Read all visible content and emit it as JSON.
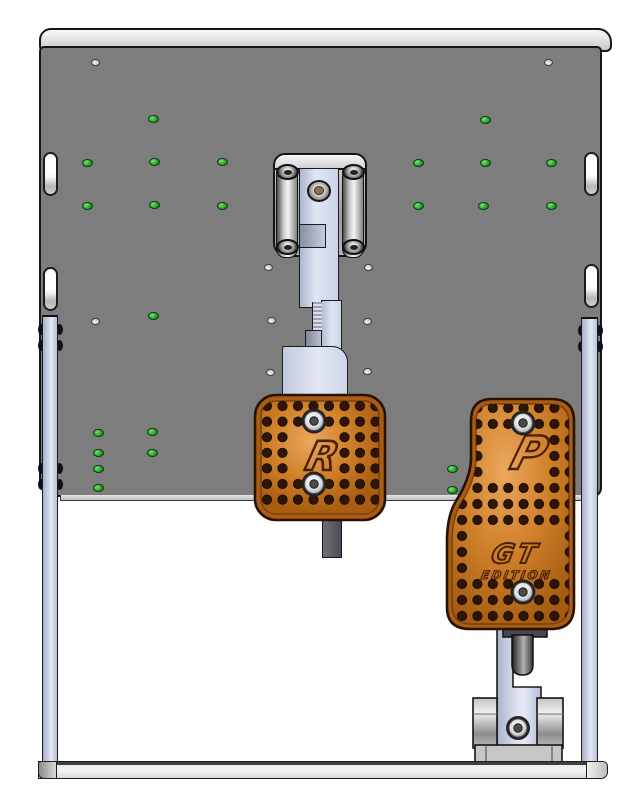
{
  "scene": {
    "subject": "Sim racing pedal set CAD assembly",
    "view": "front orthographic render",
    "pedal_count": "2"
  },
  "engravings": {
    "brake_logo": "R",
    "throttle_logo": "P",
    "throttle_series": "GT",
    "throttle_edition": "EDITION"
  },
  "colors": {
    "background": "#ffffff",
    "base_plate": "#7d7d7d",
    "plate_top_edge": "#d9d9d9",
    "outline": "#1a1a1a",
    "rail_lavender": "#ccd3e8",
    "pedal_orange": "#cf7b24",
    "pedal_orange_dark": "#9c5510",
    "engraving_brown": "#4a2106",
    "hole_green": "#27a327",
    "screw_silver": "#e8e8e8",
    "screw_brass": "#8f7446",
    "bottom_rail": "#ededed"
  },
  "holes": {
    "green": [
      [
        153,
        119
      ],
      [
        87,
        163
      ],
      [
        154,
        162
      ],
      [
        222,
        162
      ],
      [
        87,
        206
      ],
      [
        154,
        205
      ],
      [
        222,
        206
      ],
      [
        153,
        316
      ],
      [
        485,
        120
      ],
      [
        418,
        163
      ],
      [
        485,
        163
      ],
      [
        551,
        163
      ],
      [
        418,
        206
      ],
      [
        483,
        206
      ],
      [
        551,
        206
      ],
      [
        98,
        433
      ],
      [
        98,
        453
      ],
      [
        98,
        469
      ],
      [
        98,
        488
      ],
      [
        152,
        432
      ],
      [
        152,
        453
      ],
      [
        452,
        469
      ],
      [
        452,
        490
      ]
    ],
    "gray": [
      [
        95,
        62
      ],
      [
        548,
        62
      ],
      [
        268,
        267
      ],
      [
        368,
        267
      ],
      [
        271,
        320
      ],
      [
        367,
        321
      ],
      [
        270,
        372
      ],
      [
        367,
        371
      ],
      [
        95,
        321
      ]
    ],
    "slots": [
      [
        43,
        152
      ],
      [
        43,
        267
      ],
      [
        584,
        152
      ],
      [
        584,
        264
      ]
    ]
  },
  "rail_bumps": [
    [
      41,
      329
    ],
    [
      41,
      345
    ],
    [
      59,
      329
    ],
    [
      59,
      345
    ],
    [
      41,
      468
    ],
    [
      41,
      484
    ],
    [
      59,
      468
    ],
    [
      59,
      484
    ],
    [
      581,
      330
    ],
    [
      581,
      346
    ],
    [
      599,
      330
    ],
    [
      599,
      346
    ]
  ],
  "pivot_screws": [
    [
      287,
      172
    ],
    [
      353,
      172
    ],
    [
      287,
      247
    ],
    [
      353,
      247
    ]
  ],
  "pedals": {
    "brake": {
      "svg_offset": [
        246,
        388
      ],
      "screws": [
        [
          314,
          421
        ],
        [
          314,
          484
        ]
      ],
      "grid": {
        "x0": 267,
        "y0": 406,
        "dx": 15.5,
        "dy": 15.6,
        "cols": 8,
        "rows": 7
      },
      "exclude_boxes": [
        [
          294,
          436,
          344,
          478
        ]
      ],
      "screw_clearance": 13
    },
    "throttle": {
      "svg_offset": [
        438,
        391
      ],
      "screws": [
        [
          523,
          423
        ],
        [
          523,
          592
        ]
      ],
      "grid": {
        "x0": 462,
        "y0": 408,
        "dx": 15.4,
        "dy": 16,
        "cols": 8,
        "rows": 14
      },
      "exclude_boxes": [
        [
          492,
          425,
          554,
          481
        ],
        [
          472,
          534,
          562,
          582
        ]
      ],
      "screw_clearance": 13
    }
  }
}
